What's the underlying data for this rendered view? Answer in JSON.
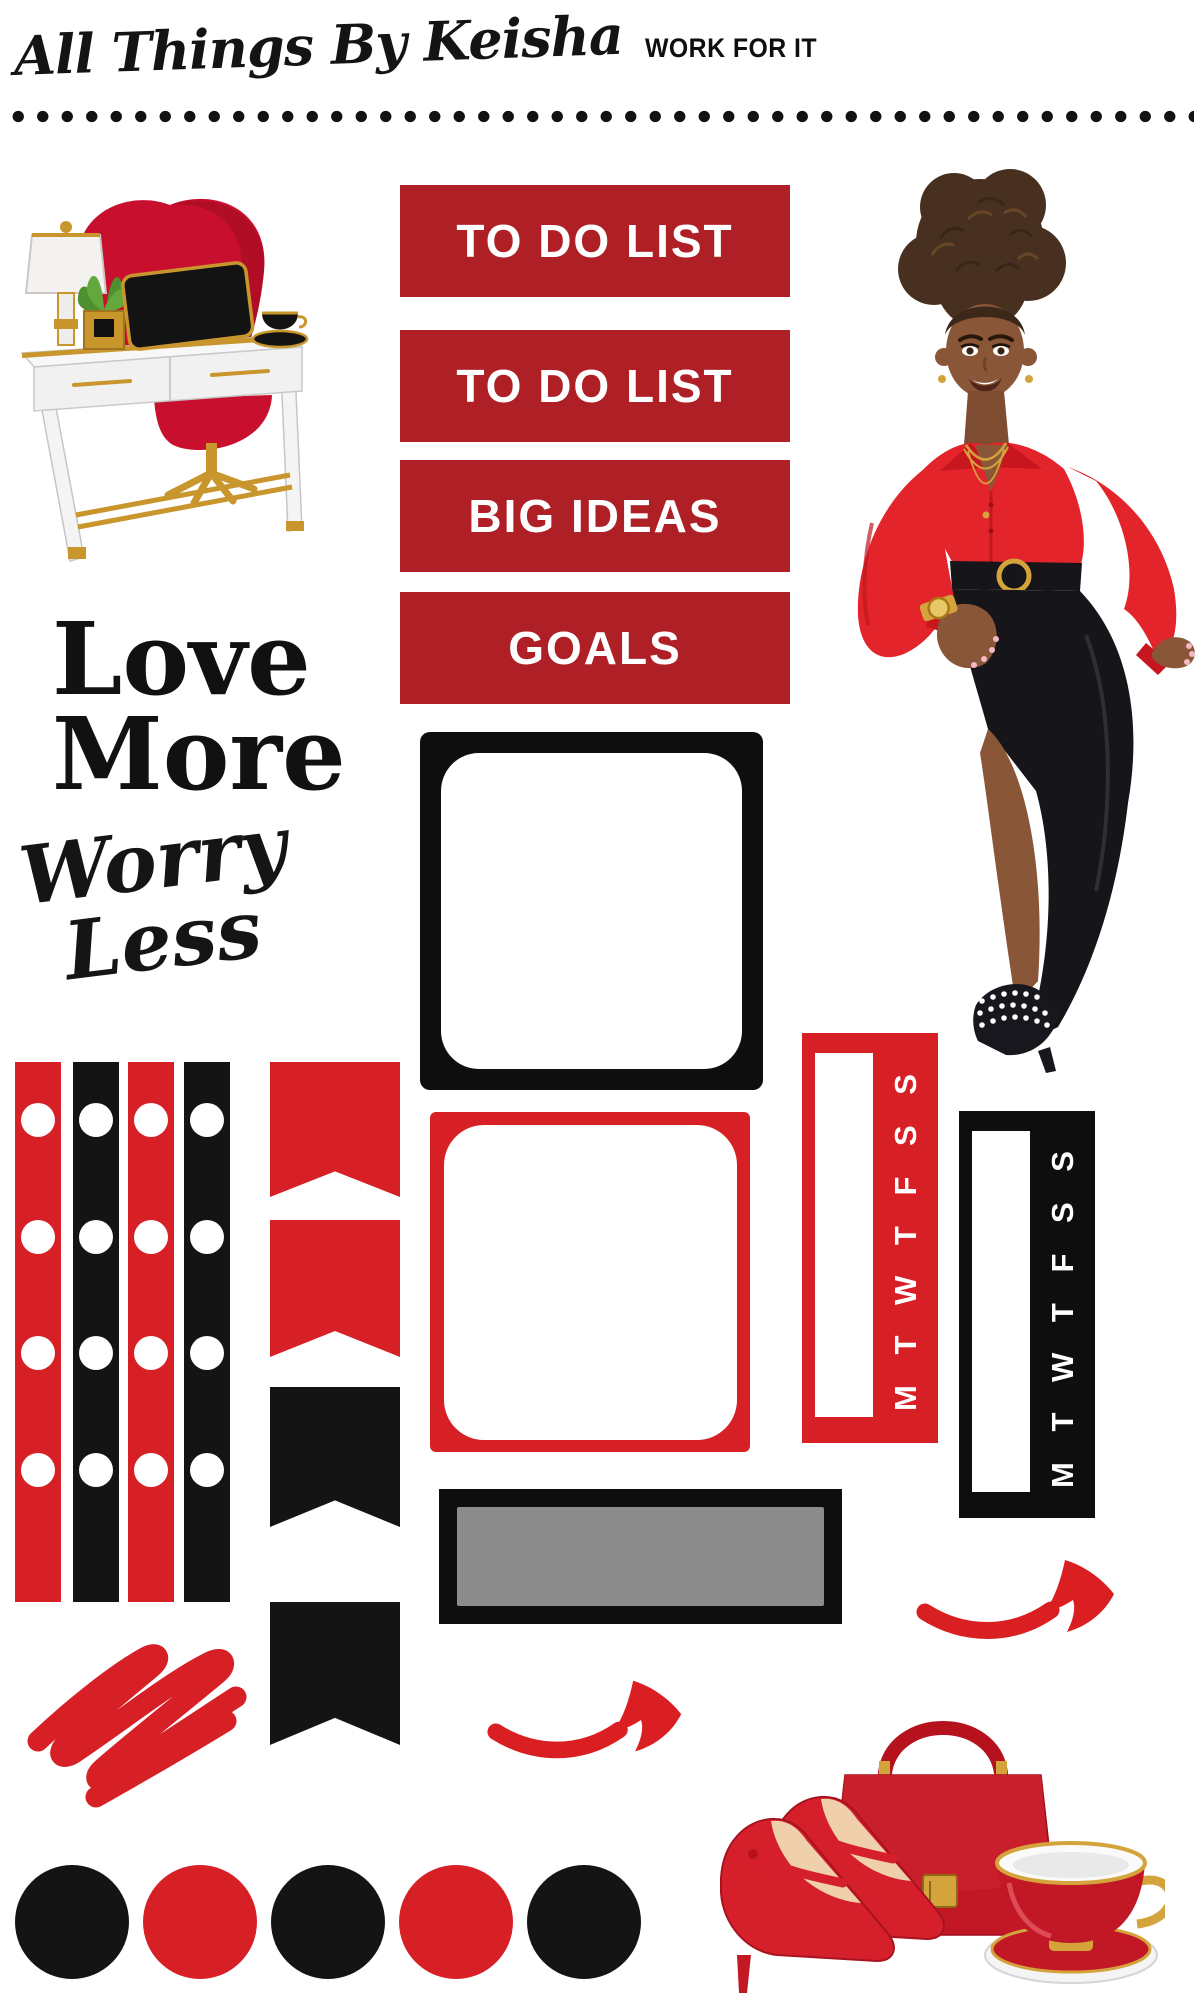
{
  "header": {
    "brand": "All Things By Keisha",
    "collection": "WORK FOR IT"
  },
  "banners": [
    {
      "label": "TO DO LIST"
    },
    {
      "label": "TO DO LIST"
    },
    {
      "label": "BIG IDEAS"
    },
    {
      "label": "GOALS"
    }
  ],
  "quotes": {
    "love_line1": "Love",
    "love_line2": "More",
    "worry_line1": "Worry",
    "worry_line2": "Less"
  },
  "day_strips": [
    {
      "color_name": "red",
      "letters": "M T W T F S S"
    },
    {
      "color_name": "black",
      "letters": "M T W T F S S"
    }
  ],
  "palette": {
    "bright_red": "#D71F26",
    "dark_red": "#AE2025",
    "black": "#141414",
    "gray": "#8C8C8C",
    "gold": "#C9962E",
    "white": "#FFFFFF"
  },
  "illustrations": {
    "desk_alt": "Red and gold desk with red egg chair, lamp, laptop, plant and coffee cup",
    "woman_alt": "Woman with curly updo wearing red blouse and black skirt",
    "accessories_alt": "Red high heels, red handbag and red teacup",
    "scribble_alt": "Red marker scribble",
    "arrow_alt": "Red curved arrow pointing right"
  },
  "decor": {
    "washi_strips": [
      {
        "color": "red",
        "holes": 4
      },
      {
        "color": "black",
        "holes": 4
      },
      {
        "color": "red",
        "holes": 4
      },
      {
        "color": "black",
        "holes": 4
      }
    ],
    "flags": [
      {
        "color": "red"
      },
      {
        "color": "red"
      },
      {
        "color": "black"
      },
      {
        "color": "black"
      }
    ],
    "dot_stickers": [
      "black",
      "red",
      "black",
      "red",
      "black"
    ],
    "boxes": [
      {
        "outline": "black",
        "fill": "white"
      },
      {
        "outline": "red",
        "fill": "white"
      },
      {
        "outline": "black",
        "fill": "gray"
      }
    ]
  }
}
